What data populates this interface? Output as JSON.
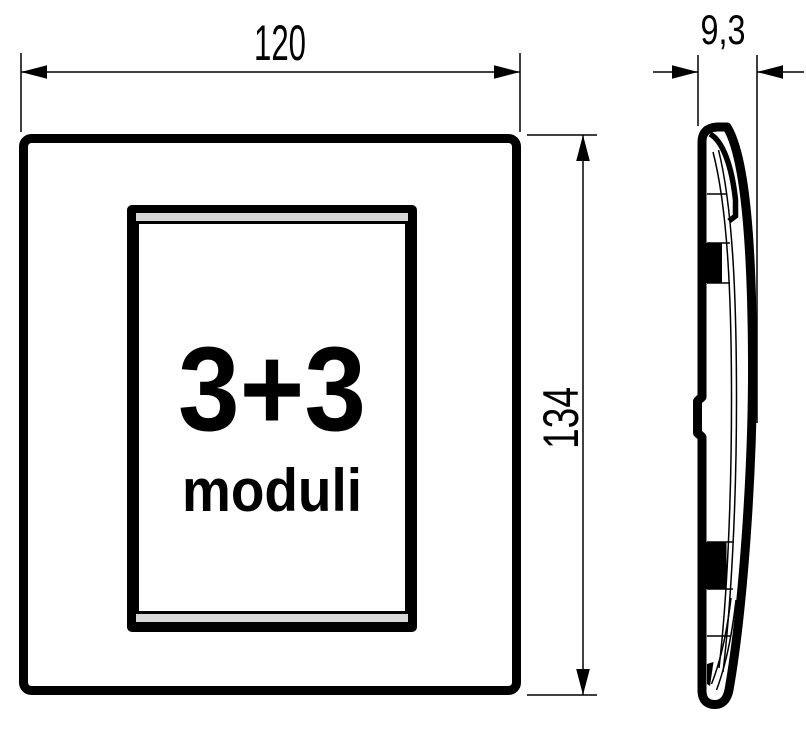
{
  "front_view": {
    "module_count": "3+3",
    "module_unit": "moduli"
  },
  "dimensions": {
    "width_mm": "120",
    "height_mm": "134",
    "depth_mm": "9,3"
  },
  "colors": {
    "line": "#000000",
    "background": "#ffffff",
    "frame_gap": "#d8d8d8"
  }
}
